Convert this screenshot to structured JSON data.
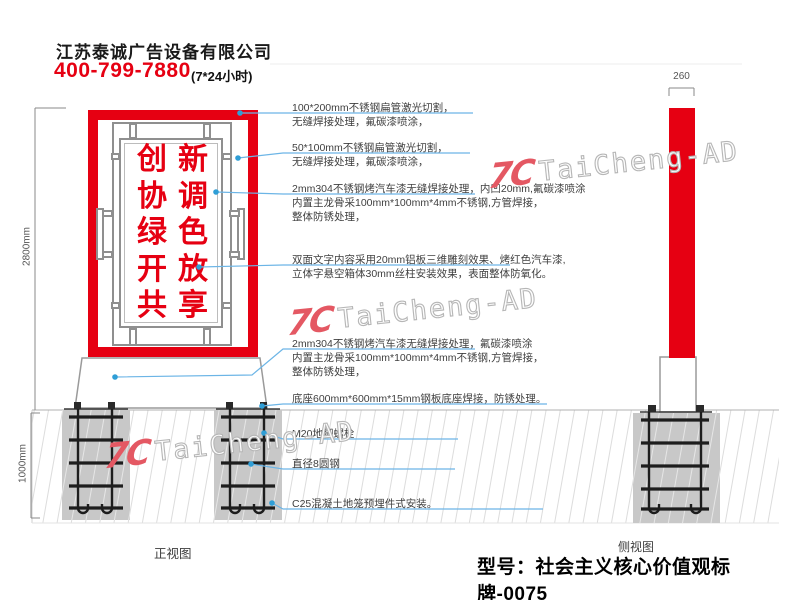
{
  "header": {
    "company": "江苏泰诚广告设备有限公司",
    "phone": "400-799-7880",
    "hours": "(7*24小时)"
  },
  "sign_text": {
    "right_column": [
      "新",
      "调",
      "色",
      "放",
      "享"
    ],
    "left_column": [
      "创",
      "协",
      "绿",
      "开",
      "共"
    ]
  },
  "dimensions": {
    "front_height": "2800mm",
    "foundation_depth": "1000mm",
    "side_width": "260"
  },
  "annotations": [
    {
      "lines": [
        "100*200mm不锈钢扁管激光切割，",
        "无缝焊接处理，氟碳漆喷涂，"
      ]
    },
    {
      "lines": [
        "50*100mm不锈钢扁管激光切割，",
        "无缝焊接处理，氟碳漆喷涂，"
      ]
    },
    {
      "lines": [
        "2mm304不锈钢烤汽车漆无缝焊接处理，内凹20mm,氟碳漆喷涂",
        "内置主龙骨采100mm*100mm*4mm不锈钢,方管焊接，",
        "整体防锈处理，"
      ]
    },
    {
      "lines": [
        "双面文字内容采用20mm铝板三维雕刻效果、烤红色汽车漆,",
        "立体字悬空箱体30mm丝柱安装效果，表面整体防氧化。"
      ]
    },
    {
      "lines": [
        "2mm304不锈钢烤汽车漆无缝焊接处理，氟碳漆喷涂",
        "内置主龙骨采100mm*100mm*4mm不锈钢,方管焊接，",
        "整体防锈处理，"
      ]
    },
    {
      "lines": [
        "底座600mm*600mm*15mm钢板底座焊接，防锈处理。"
      ]
    },
    {
      "lines": [
        "M20地脚螺栓"
      ]
    },
    {
      "lines": [
        "直径8圆钢"
      ]
    },
    {
      "lines": [
        "C25混凝土地笼预埋件式安装。"
      ]
    }
  ],
  "view_labels": {
    "front": "正视图",
    "side": "侧视图"
  },
  "model_label": "型号：社会主义核心价值观标牌-0075",
  "watermark": {
    "logo": "7C",
    "text": "TaiCheng-AD"
  },
  "colors": {
    "accent_red": "#e60012",
    "leader_blue": "#6cb5e6",
    "dot_blue": "#2f9ed6",
    "concrete_gray": "#c8c8c8",
    "watermark_pink": "#e45863"
  }
}
